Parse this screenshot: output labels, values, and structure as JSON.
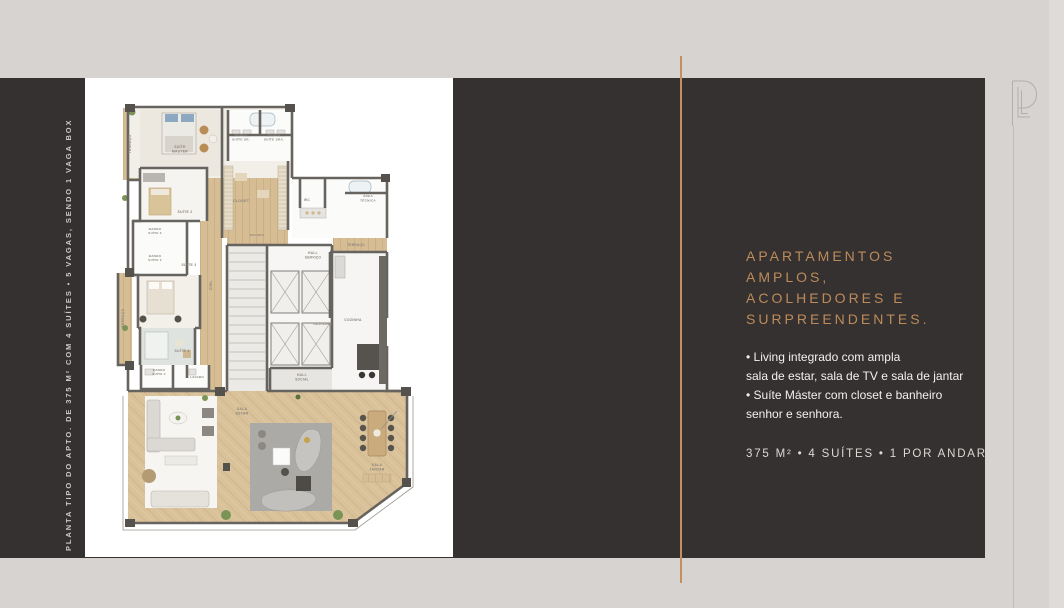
{
  "page": {
    "background": "#d6d3d0",
    "panel_color": "#343130",
    "accent_gold": "#bd8b5a",
    "divider_gold": "#c4905c"
  },
  "left_caption": "PLANTA TIPO DO APTO. DE 375 M² COM 4 SUÍTES • 5 VAGAS, SENDO 1 VAGA BOX",
  "right": {
    "heading": "APARTAMENTOS\nAMPLOS,\nACOLHEDORES E\nSURPREENDENTES.",
    "bullets": [
      "• Living integrado com ampla\n   sala de estar, sala de TV e sala de jantar",
      "• Suíte Máster com closet e banheiro\n   senhor e senhora."
    ],
    "stats": "375 M² • 4 SUÍTES • 1 POR ANDAR"
  },
  "brand": {
    "monogram": "PL-monogram"
  },
  "floorplan": {
    "palette": {
      "wall": "#67645f",
      "wood": "#d9c199",
      "rug": "#abaaa7",
      "greenery": "#7a9456",
      "counter_dark": "#56534f"
    },
    "labels": [
      {
        "t": "TERRAÇO",
        "x": 46,
        "y": 66,
        "r": -90,
        "s": 3.4
      },
      {
        "t": "SUÍTE\nMASTER",
        "x": 95,
        "y": 70,
        "s": 3.4
      },
      {
        "t": "BANHO\nSUÍTE SR.",
        "x": 156,
        "y": 58,
        "s": 3.1
      },
      {
        "t": "BANHO\nSUÍTE SRA.",
        "x": 189,
        "y": 58,
        "s": 3.1
      },
      {
        "t": "CLOSET",
        "x": 156,
        "y": 124,
        "s": 3.6
      },
      {
        "t": "WC",
        "x": 222,
        "y": 123,
        "s": 3.2
      },
      {
        "t": "ÁREA\nTÉCNICA",
        "x": 283,
        "y": 119,
        "s": 3.1
      },
      {
        "t": "TERRAÇO",
        "x": 271,
        "y": 168,
        "s": 3.2
      },
      {
        "t": "SUÍTE 2",
        "x": 100,
        "y": 135,
        "s": 3.4
      },
      {
        "t": "BANHO\nSUÍTE 2",
        "x": 70,
        "y": 152,
        "s": 3.0
      },
      {
        "t": "BANHO\nSUÍTE 3",
        "x": 70,
        "y": 179,
        "s": 3.0
      },
      {
        "t": "SUÍTE 3",
        "x": 104,
        "y": 188,
        "s": 3.4
      },
      {
        "t": "TERRAÇO",
        "x": 39,
        "y": 240,
        "r": -90,
        "s": 3.4
      },
      {
        "t": "CIRC.",
        "x": 127,
        "y": 207,
        "r": -90,
        "s": 3.2
      },
      {
        "t": "ESCADA",
        "x": 172,
        "y": 158,
        "s": 3.0
      },
      {
        "t": "SUÍTE 4",
        "x": 97,
        "y": 274,
        "s": 3.4
      },
      {
        "t": "BANHO\nSUÍTE 4",
        "x": 74,
        "y": 293,
        "s": 3.0
      },
      {
        "t": "LAVABO",
        "x": 112,
        "y": 300,
        "s": 3.0
      },
      {
        "t": "HALL\nSERVIÇO",
        "x": 228,
        "y": 176,
        "s": 3.2
      },
      {
        "t": "DESPENSA",
        "x": 238,
        "y": 247,
        "s": 3.0
      },
      {
        "t": "HALL\nSOCIAL",
        "x": 217,
        "y": 298,
        "s": 3.2
      },
      {
        "t": "COZINHA",
        "x": 268,
        "y": 243,
        "s": 3.4
      },
      {
        "t": "SALA\nESTAR",
        "x": 157,
        "y": 332,
        "s": 3.4
      },
      {
        "t": "SALA\nJANTAR",
        "x": 292,
        "y": 388,
        "s": 3.4
      }
    ]
  }
}
